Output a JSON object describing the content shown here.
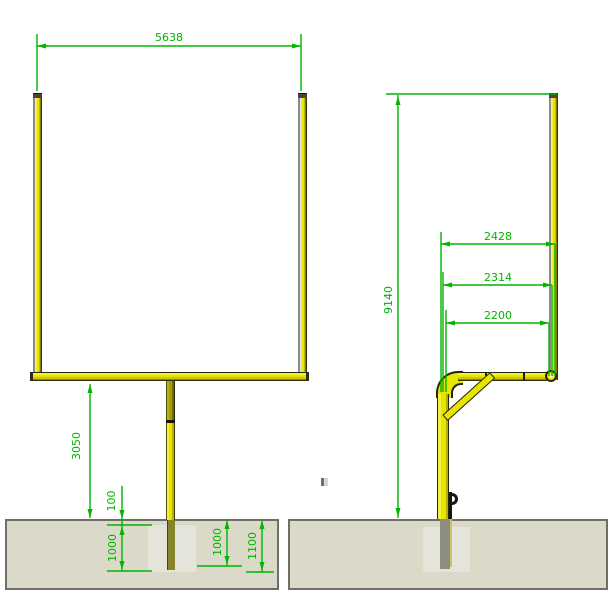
{
  "colors": {
    "dimension_green": "#00b400",
    "post_yellow": "#e9e500",
    "ground_gray": "#dbdac8",
    "footing_gray": "#e5e4da"
  },
  "front_view": {
    "dims": {
      "goal_width": "5638",
      "crossbar_height": "3050",
      "footing_cover": "100",
      "footing_depth": "1000",
      "post_embedment": "1000",
      "excavation_depth": "1100"
    }
  },
  "side_view": {
    "dims": {
      "overall_height": "9140",
      "overhang_top": "2428",
      "overhang_mid": "2314",
      "overhang_bottom": "2200"
    }
  }
}
